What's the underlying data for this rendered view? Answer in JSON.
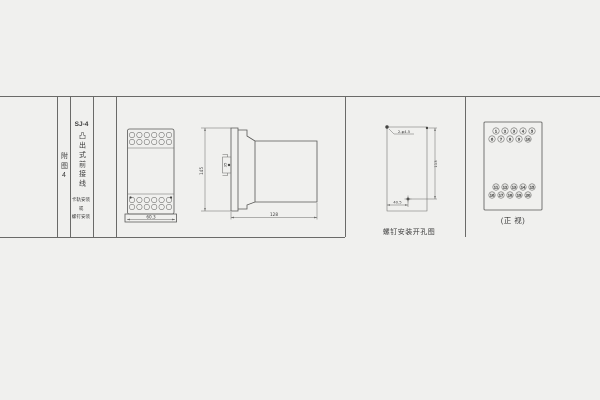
{
  "page": {
    "background": "#f0f0ee",
    "line_color": "#6a6a68"
  },
  "title_block": {
    "figure_no": "附图4",
    "model": "SJ-4",
    "wiring_type": "凸出式前接线",
    "mount_lines": [
      "卡轨安装",
      "或",
      "螺钉安装"
    ]
  },
  "views": {
    "front": {
      "width_dim": "60.3"
    },
    "side": {
      "height_dim": "145",
      "clip_dim": "35",
      "depth_dim": "128"
    },
    "drill": {
      "holes_note": "2-φ4.5",
      "height_dim": "113",
      "width_dim": "40.5",
      "caption": "螺钉安装开孔图"
    },
    "terminals": {
      "caption": "(正 视)",
      "top_rows": [
        [
          "1",
          "2",
          "3",
          "4",
          "5"
        ],
        [
          "6",
          "7",
          "8",
          "9",
          "10"
        ]
      ],
      "bottom_rows": [
        [
          "11",
          "12",
          "13",
          "14",
          "15"
        ],
        [
          "16",
          "17",
          "18",
          "19",
          "20"
        ]
      ]
    }
  }
}
